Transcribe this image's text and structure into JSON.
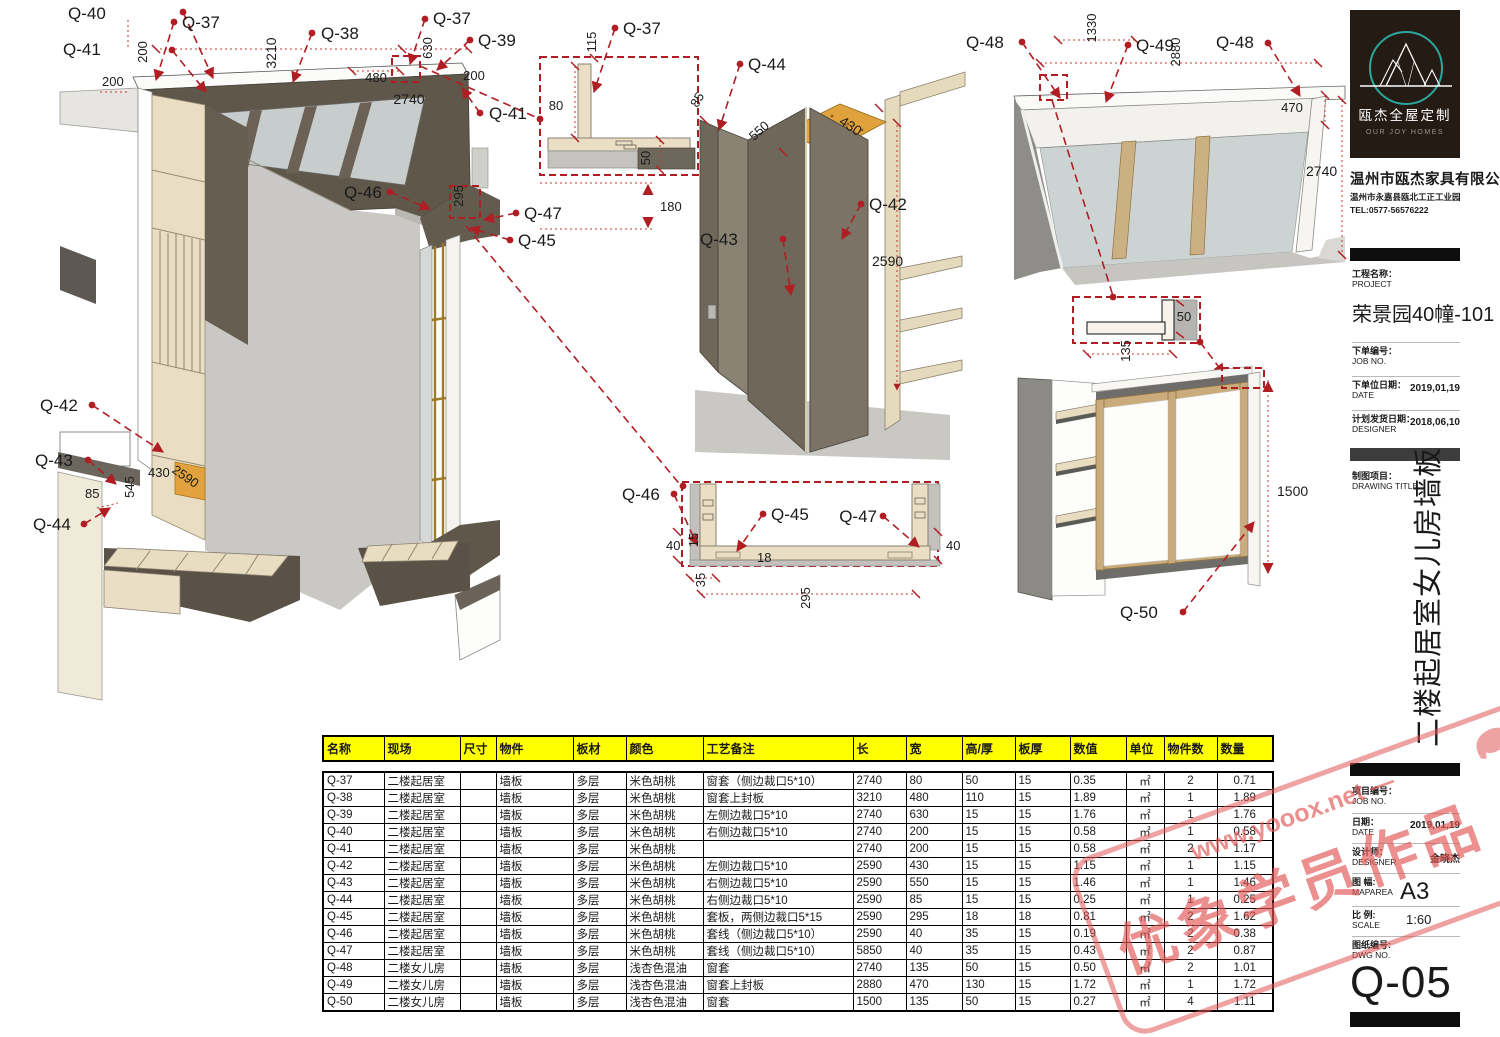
{
  "logo": {
    "brand": "瓯杰全屋定制",
    "brand_en": "OUR JOY HOMES"
  },
  "company": {
    "name": "温州市瓯杰家具有限公司",
    "address": "温州市永嘉县瓯北工正工业园",
    "tel": "TEL:0577-56576222"
  },
  "titleblock": {
    "project_label": "工程名称：",
    "project_label_en": "PROJECT",
    "project_name": "荣景园40幢-101",
    "job_label": "下单编号：",
    "job_label_en": "JOB NO.",
    "order_date_label": "下单位日期：",
    "order_date_label_en": "DATE",
    "order_date": "2019,01,19",
    "ship_date_label": "计划发货日期：",
    "ship_date_label_en": "DESIGNER",
    "ship_date": "2018,06,10",
    "drawing_label": "制图项目：",
    "drawing_label_en": "DRAWING TITLE",
    "drawing_title": "二楼起居室女儿房墙板",
    "job2_label": "项目编号：",
    "job2_label_en": "JOB NO.",
    "date2_label": "日期：",
    "date2_label_en": "DATE",
    "date2": "2019,01,19",
    "designer_label": "设计师：",
    "designer_label_en": "DESIGNER",
    "designer": "金晓杰",
    "maparea_label": "图 幅:",
    "maparea_label_en": "MAPAREA",
    "maparea": "A3",
    "scale_label": "比 例:",
    "scale_label_en": "SCALE",
    "scale": "1:60",
    "dwg_label": "图纸编号:",
    "dwg_label_en": "DWG NO.",
    "dwg_no": "Q-05"
  },
  "watermark": {
    "site": "www.yooox.net —",
    "label": "优象学员作品"
  },
  "table": {
    "headers": [
      "名称",
      "现场",
      "尺寸",
      "物件",
      "板材",
      "颜色",
      "工艺备注",
      "长",
      "宽",
      "高/厚",
      "板厚",
      "数值",
      "单位",
      "物件数",
      "数量"
    ],
    "rows": [
      [
        "Q-37",
        "二楼起居室",
        "",
        "墙板",
        "多层",
        "米色胡桃",
        "窗套（侧边裁口5*10）",
        "2740",
        "80",
        "50",
        "15",
        "0.35",
        "㎡",
        "2",
        "0.71"
      ],
      [
        "Q-38",
        "二楼起居室",
        "",
        "墙板",
        "多层",
        "米色胡桃",
        "窗套上封板",
        "3210",
        "480",
        "110",
        "15",
        "1.89",
        "㎡",
        "1",
        "1.89"
      ],
      [
        "Q-39",
        "二楼起居室",
        "",
        "墙板",
        "多层",
        "米色胡桃",
        "左侧边裁口5*10",
        "2740",
        "630",
        "15",
        "15",
        "1.76",
        "㎡",
        "1",
        "1.76"
      ],
      [
        "Q-40",
        "二楼起居室",
        "",
        "墙板",
        "多层",
        "米色胡桃",
        "右侧边裁口5*10",
        "2740",
        "200",
        "15",
        "15",
        "0.58",
        "㎡",
        "1",
        "0.58"
      ],
      [
        "Q-41",
        "二楼起居室",
        "",
        "墙板",
        "多层",
        "米色胡桃",
        "",
        "2740",
        "200",
        "15",
        "15",
        "0.58",
        "㎡",
        "2",
        "1.17"
      ],
      [
        "Q-42",
        "二楼起居室",
        "",
        "墙板",
        "多层",
        "米色胡桃",
        "左侧边裁口5*10",
        "2590",
        "430",
        "15",
        "15",
        "1.15",
        "㎡",
        "1",
        "1.15"
      ],
      [
        "Q-43",
        "二楼起居室",
        "",
        "墙板",
        "多层",
        "米色胡桃",
        "右侧边裁口5*10",
        "2590",
        "550",
        "15",
        "15",
        "1.46",
        "㎡",
        "1",
        "1.46"
      ],
      [
        "Q-44",
        "二楼起居室",
        "",
        "墙板",
        "多层",
        "米色胡桃",
        "右侧边裁口5*10",
        "2590",
        "85",
        "15",
        "15",
        "0.25",
        "㎡",
        "1",
        "0.25"
      ],
      [
        "Q-45",
        "二楼起居室",
        "",
        "墙板",
        "多层",
        "米色胡桃",
        "套板，两侧边裁口5*15",
        "2590",
        "295",
        "18",
        "18",
        "0.81",
        "㎡",
        "2",
        "1.62"
      ],
      [
        "Q-46",
        "二楼起居室",
        "",
        "墙板",
        "多层",
        "米色胡桃",
        "套线（侧边裁口5*10）",
        "2590",
        "40",
        "35",
        "15",
        "0.19",
        "㎡",
        "2",
        "0.38"
      ],
      [
        "Q-47",
        "二楼起居室",
        "",
        "墙板",
        "多层",
        "米色胡桃",
        "套线（侧边裁口5*10）",
        "5850",
        "40",
        "35",
        "15",
        "0.43",
        "㎡",
        "2",
        "0.87"
      ],
      [
        "Q-48",
        "二楼女儿房",
        "",
        "墙板",
        "多层",
        "浅杏色混油",
        "窗套",
        "2740",
        "135",
        "50",
        "15",
        "0.50",
        "㎡",
        "2",
        "1.01"
      ],
      [
        "Q-49",
        "二楼女儿房",
        "",
        "墙板",
        "多层",
        "浅杏色混油",
        "窗套上封板",
        "2880",
        "470",
        "130",
        "15",
        "1.72",
        "㎡",
        "1",
        "1.72"
      ],
      [
        "Q-50",
        "二楼女儿房",
        "",
        "墙板",
        "多层",
        "浅杏色混油",
        "窗套",
        "1500",
        "135",
        "50",
        "15",
        "0.27",
        "㎡",
        "4",
        "1.11"
      ]
    ]
  },
  "ann": {
    "room": {
      "labels": [
        "Q-40",
        "Q-37",
        "Q-41",
        "Q-38",
        "Q-37",
        "Q-39",
        "Q-41",
        "Q-46",
        "Q-47",
        "Q-45",
        "Q-42",
        "Q-43",
        "Q-44"
      ],
      "dims": [
        "200",
        "3210",
        "630",
        "480",
        "200",
        "200",
        "2740",
        "295",
        "85",
        "545",
        "430",
        "2590"
      ]
    },
    "window_detail": {
      "label": "Q-37",
      "dims": [
        "115",
        "80",
        "50",
        "180"
      ]
    },
    "corner": {
      "labels": [
        "Q-44",
        "Q-42",
        "Q-43"
      ],
      "dims": [
        "85",
        "550",
        "430",
        "2590"
      ]
    },
    "channel_detail": {
      "labels": [
        "Q-46",
        "Q-45",
        "Q-47"
      ],
      "dims": [
        "40",
        "15",
        "18",
        "40",
        "35",
        "295"
      ]
    },
    "window_top": {
      "labels": [
        "Q-48",
        "Q-49",
        "Q-48"
      ],
      "dims": [
        "1330",
        "2880",
        "470",
        "2740"
      ]
    },
    "corner_detail": {
      "dims": [
        "50",
        "135"
      ]
    },
    "window_side": {
      "label": "Q-50",
      "dims": [
        "1500"
      ]
    }
  }
}
